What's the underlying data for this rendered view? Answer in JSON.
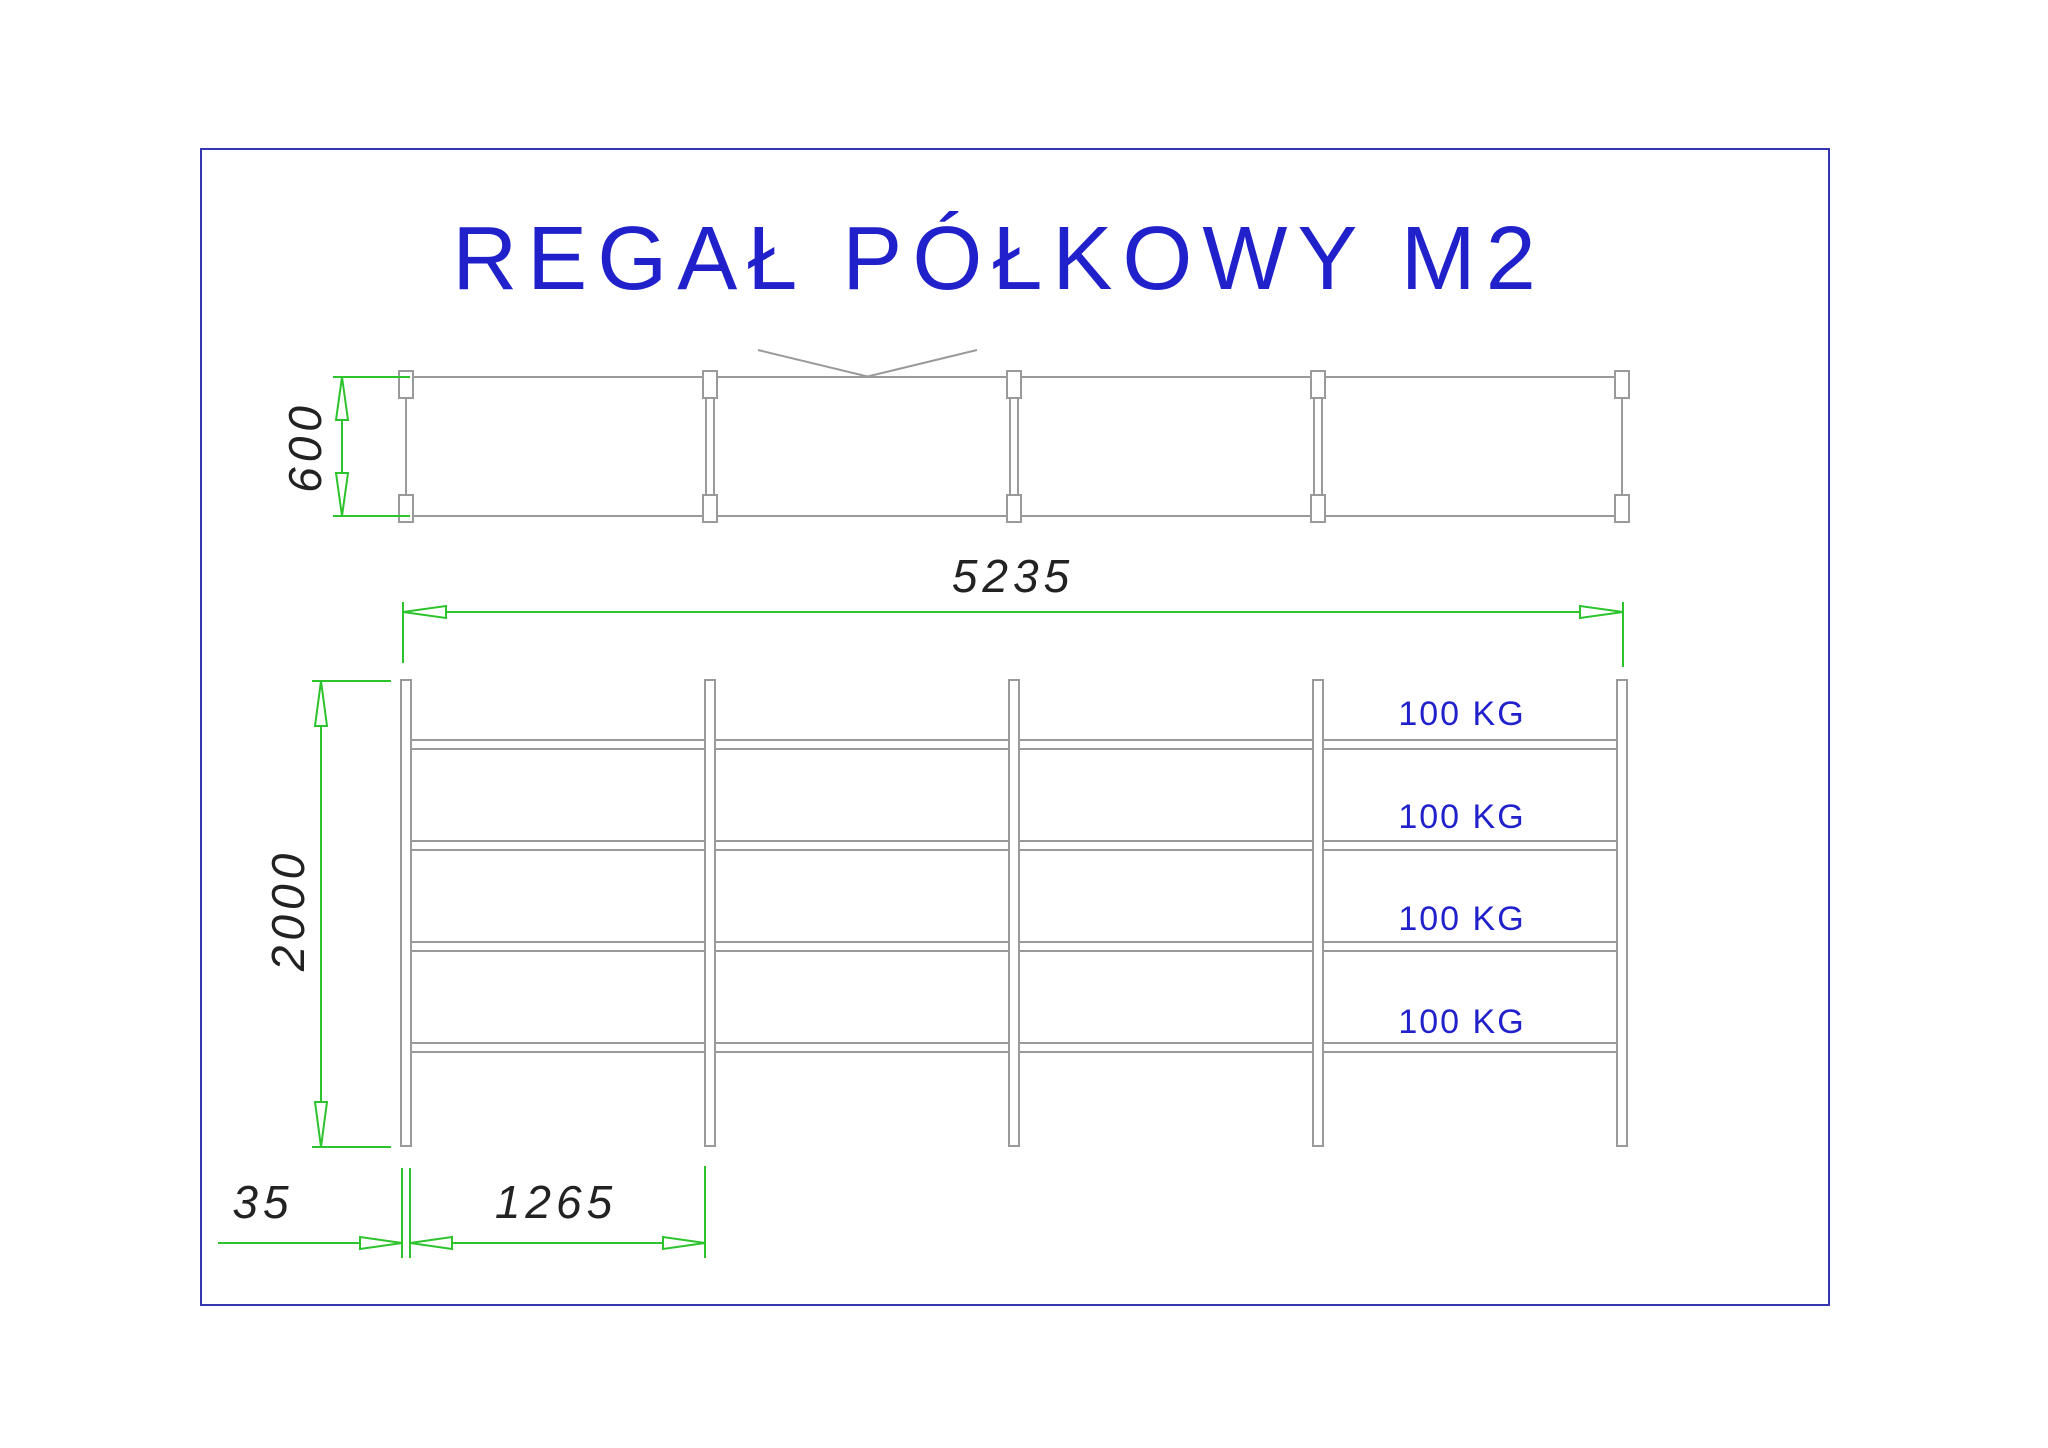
{
  "title": "REGAŁ PÓŁKOWY M2",
  "top_view": {
    "depth_dim": "600",
    "sections": 4,
    "has_cross_brace": true
  },
  "front_view": {
    "width_dim": "5235",
    "height_dim": "2000",
    "post_width_dim": "35",
    "bay_width_dim": "1265",
    "posts": 5,
    "shelves": 4,
    "shelf_loads": [
      "100 KG",
      "100 KG",
      "100 KG",
      "100 KG"
    ]
  },
  "colors": {
    "dimension_green": "#2cc32c",
    "linework_gray": "#9a9a9a",
    "accent_blue": "#2121cc",
    "frame_blue": "#3636b0",
    "dim_text": "#222222"
  }
}
